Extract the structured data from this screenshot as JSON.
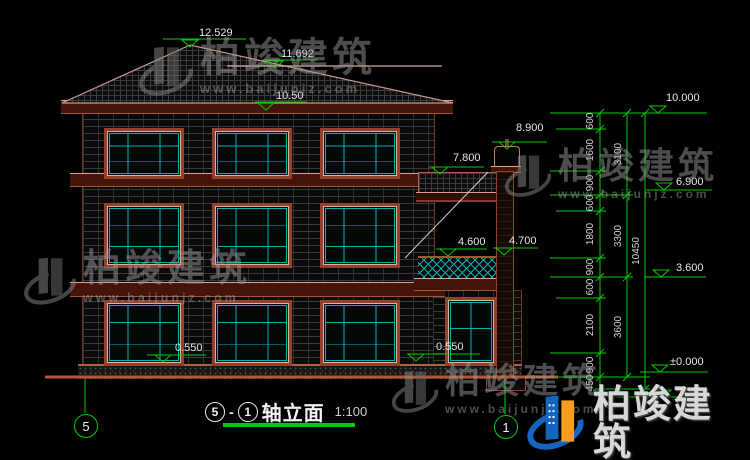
{
  "drawing": {
    "title": {
      "axis_from": "5",
      "separator": "-",
      "axis_to": "1",
      "name": "轴立面",
      "scale": "1:100"
    },
    "axis_bubbles": {
      "left": "5",
      "right": "1"
    },
    "elevations": {
      "ridge": "12.529",
      "upper_ridge": "11.692",
      "eave": "10.50",
      "pillar_top": "8.900",
      "porch_roof": "7.800",
      "balcony_rail": "4.600",
      "balcony_col": "4.700",
      "plinth_left": "0.550",
      "plinth_right": "0.550",
      "level_top": "10.000",
      "level_third": "6.900",
      "level_second": "3.600",
      "level_ground": "±0.000"
    },
    "dims_inner": [
      "600",
      "1600",
      "900",
      "600",
      "1800",
      "900",
      "600",
      "2100",
      "900",
      "450"
    ],
    "dims_middle": [
      "3100",
      "3300",
      "3600"
    ],
    "dims_total": "10450"
  },
  "watermark": {
    "brand": "柏竣建筑",
    "url": "www.baijunjz.com"
  },
  "colors": {
    "dim_green": "#00cc00",
    "outline_red": "#93402c",
    "window_cyan": "#00b4b4",
    "logo_blue": "#1565c0",
    "logo_orange": "#f59f1c"
  }
}
